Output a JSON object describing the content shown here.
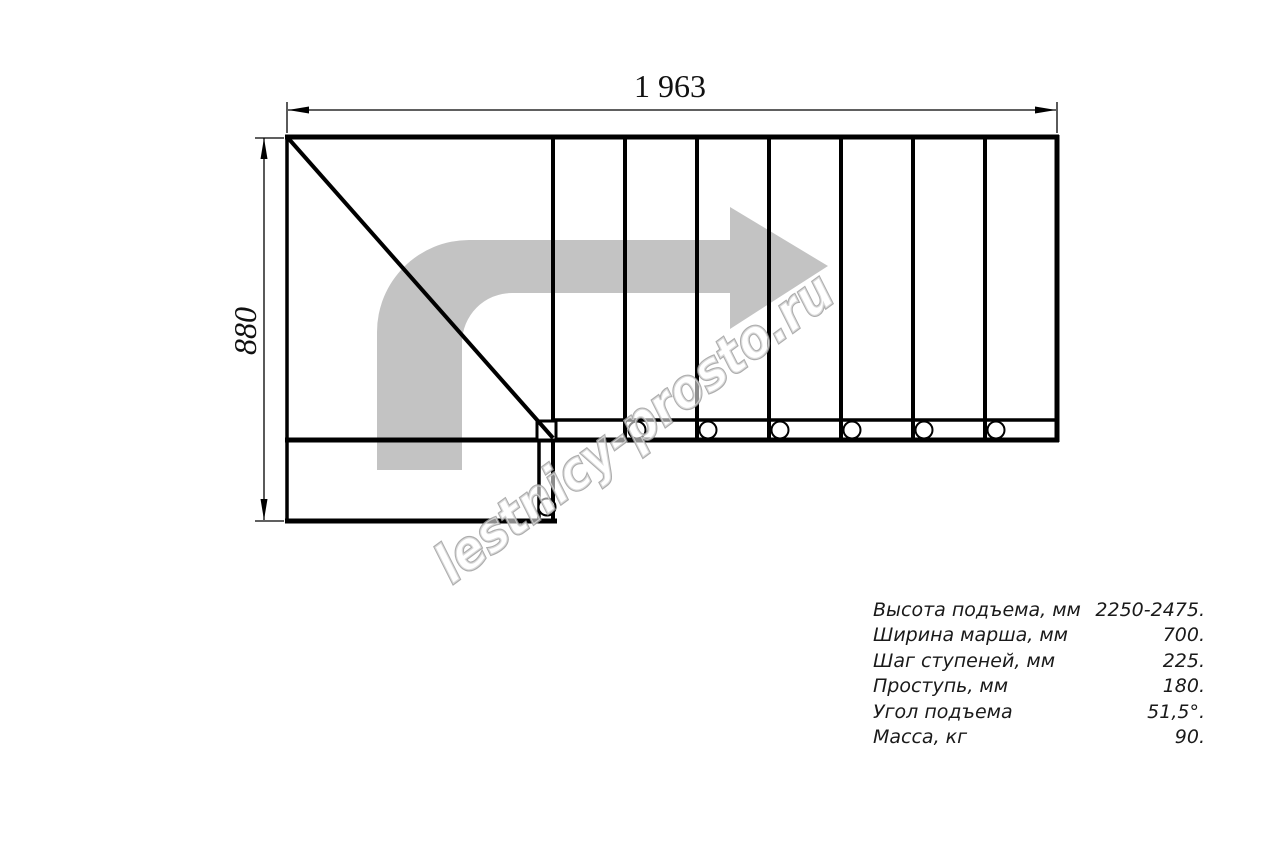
{
  "drawing": {
    "type": "staircase-plan-top-view",
    "dimension_top": "1 963",
    "dimension_left": "880",
    "direction_arrow": "curved-arrow-up-then-right",
    "colors": {
      "line": "#000000",
      "arrow_fill": "#c3c3c3",
      "watermark_outline": "#9f9f9f",
      "background": "#ffffff"
    }
  },
  "watermark": {
    "text": "lestnicy-prosto.ru"
  },
  "specs": {
    "rows": [
      {
        "label": "Высота подъема, мм",
        "value": "2250-2475."
      },
      {
        "label": "Ширина марша, мм",
        "value": "700."
      },
      {
        "label": "Шаг ступеней, мм",
        "value": "225."
      },
      {
        "label": "Проступь, мм",
        "value": "180."
      },
      {
        "label": "Угол подъема",
        "value": "51,5°."
      },
      {
        "label": "Масса, кг",
        "value": "90."
      }
    ]
  }
}
